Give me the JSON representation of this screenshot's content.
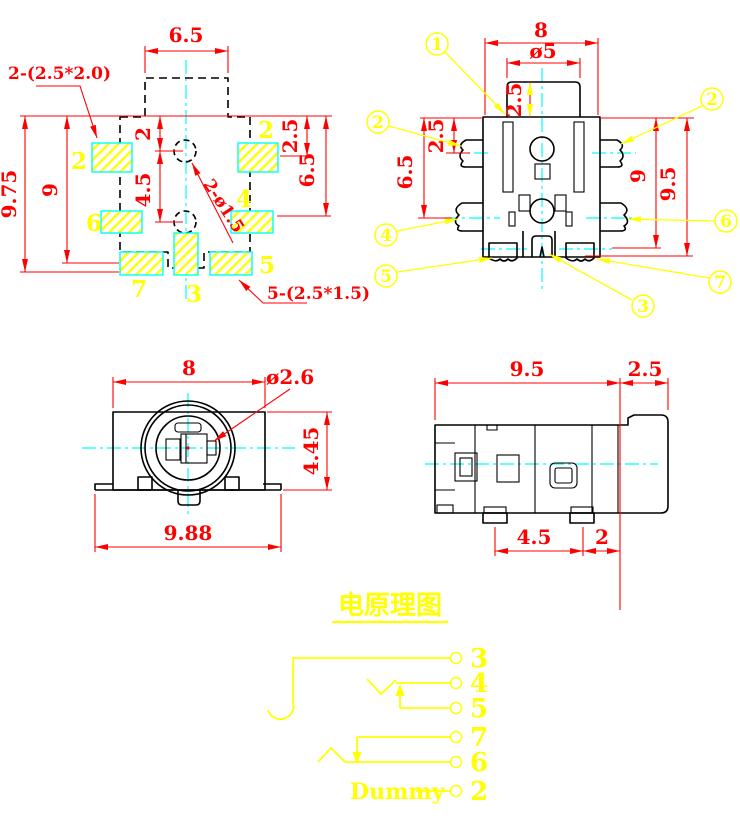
{
  "footprint": {
    "dim_top_width": "6.5",
    "dim_overall_height": "9.75",
    "dim_pad_rows_height": "9",
    "dim_hole1_offset": "2",
    "dim_hole_pitch": "4.5",
    "dim_right_row1": "2.5",
    "dim_right_row2": "6.5",
    "note_side_pads": "2-(2.5*2.0)",
    "note_bottom_pads": "5-(2.5*1.5)",
    "note_holes": "2-ø1.5",
    "pad_labels": {
      "left2": "2",
      "right2": "2",
      "p6": "6",
      "p4": "4",
      "p7": "7",
      "p3": "3",
      "p5": "5"
    }
  },
  "bottom_view": {
    "dim_body_width": "8",
    "dim_boss_dia": "ø5",
    "dim_boss_height": "2.5",
    "dim_pin_row1": "2.5",
    "dim_pin_row2": "6.5",
    "dim_pin_row3": "9",
    "dim_overall_height": "9.5",
    "callouts": {
      "c1": "1",
      "c2_left": "2",
      "c2_right": "2",
      "c3": "3",
      "c4": "4",
      "c5": "5",
      "c6": "6",
      "c7": "7"
    }
  },
  "front_view": {
    "dim_width": "8",
    "dim_pin_dia": "ø2.6",
    "dim_height": "4.45",
    "dim_flange_width": "9.88"
  },
  "side_view": {
    "dim_body_depth": "9.5",
    "dim_barrel": "2.5",
    "dim_feet_pitch": "4.5",
    "dim_feet_to_edge": "2"
  },
  "schematic": {
    "title": "电原理图",
    "pins": [
      "3",
      "4",
      "5",
      "7",
      "6",
      "2"
    ],
    "dummy_label": "Dummy"
  },
  "colors": {
    "dimension_red": "#ff0000",
    "annotation_yellow": "#ffff00",
    "centerline_cyan": "#00ffff",
    "outline_black": "#000000",
    "background": "#ffffff"
  }
}
